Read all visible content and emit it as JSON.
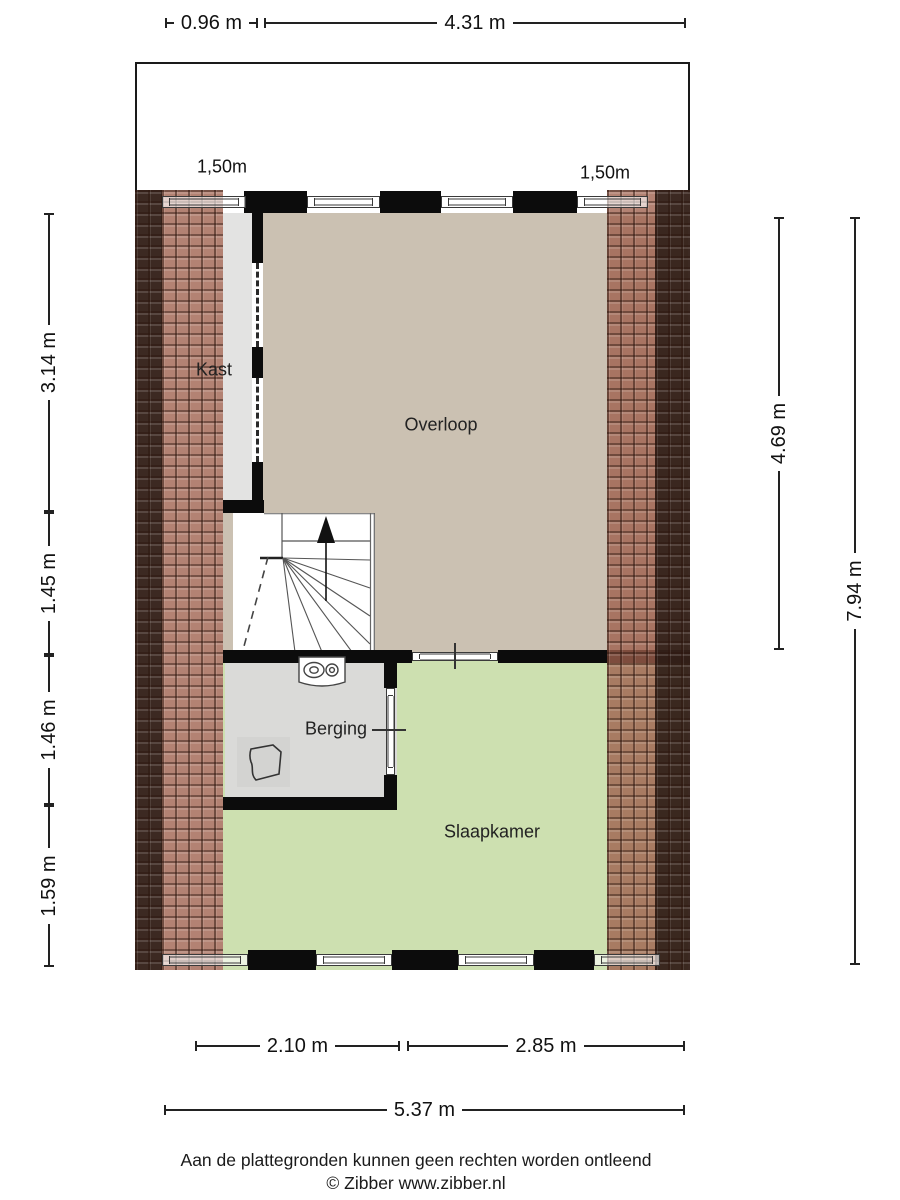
{
  "dimensions": {
    "top": [
      {
        "label": "0.96 m"
      },
      {
        "label": "4.31 m"
      },
      {
        "label": "4.15 m"
      }
    ],
    "clearance_left": "1,50m",
    "clearance_right": "1,50m",
    "left": [
      {
        "label": "3.14 m"
      },
      {
        "label": "1.45 m"
      },
      {
        "label": "1.46 m"
      },
      {
        "label": "1.59 m"
      }
    ],
    "right": [
      {
        "label": "4.69 m"
      },
      {
        "label": "7.94 m"
      }
    ],
    "bottom": [
      {
        "label": "2.10 m"
      },
      {
        "label": "2.85 m"
      },
      {
        "label": "5.37 m"
      }
    ]
  },
  "rooms": {
    "kast": "Kast",
    "overloop": "Overloop",
    "berging": "Berging",
    "slaapkamer": "Slaapkamer"
  },
  "footer": {
    "disclaimer": "Aan de plattegronden kunnen geen rechten worden ontleend",
    "copyright": "© Zibber www.zibber.nl"
  },
  "colors": {
    "overloop_fill": "#cbc1b2",
    "slaapkamer_fill": "#cde0b0",
    "kast_fill": "#e3e3e2",
    "berging_fill": "#dadad8",
    "roof_tile_light": "#b38273",
    "roof_tile_dark": "#46302a",
    "wall": "#0c0c0c"
  }
}
